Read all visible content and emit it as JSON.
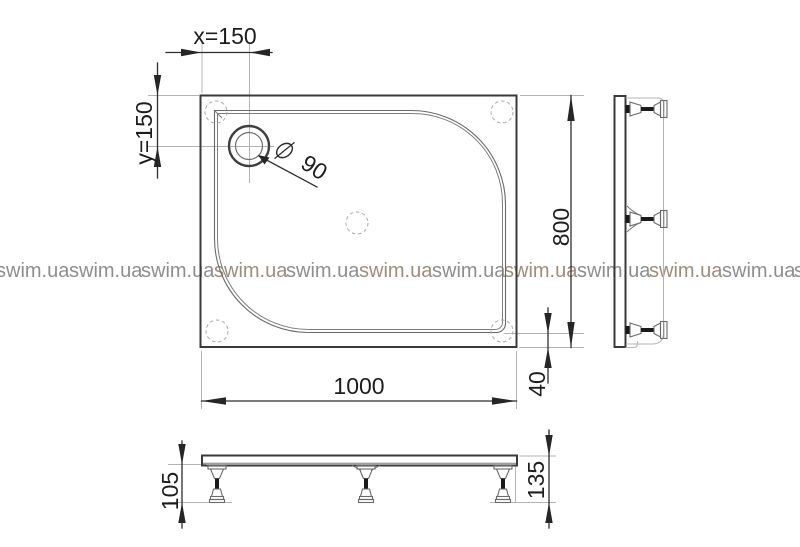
{
  "watermark": {
    "text": "swim.ua"
  },
  "plan": {
    "label_x_offset": "x=150",
    "label_y_offset": "y=150",
    "label_height": "800",
    "label_width": "1000",
    "label_rim": "40",
    "label_drain_diameter": "90"
  },
  "front": {
    "label_leg_height": "105",
    "label_total_height": "135"
  },
  "colors": {
    "line": "#2e2e2e",
    "light_line": "#b4b4b4",
    "watermark_gray": "#8e8e8e",
    "watermark_warm": "#a08c78"
  }
}
